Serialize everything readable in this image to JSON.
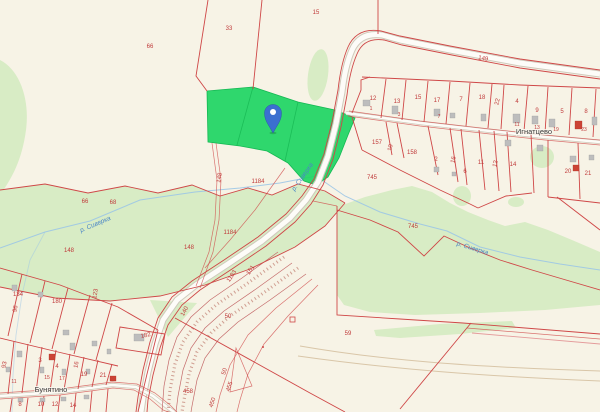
{
  "map": {
    "colors": {
      "background": "#f7f3e6",
      "vegetation": "#d8ecc5",
      "selection_green": "#1fd463",
      "boundary_red": "#cf4747",
      "road_fill": "#fdfcf8",
      "water_blue": "#9cc6e6",
      "marker_blue": "#3b6fd0",
      "parcel_number_red": "#c03b3b",
      "settlement_text": "#3b3b3b"
    },
    "marker": {
      "type": "location-pin",
      "x": 273,
      "y": 113
    },
    "settlements": [
      {
        "t": "Игнатцево",
        "x": 534,
        "y": 134
      },
      {
        "t": "Бунятино",
        "x": 51,
        "y": 392
      }
    ],
    "rivers": [
      {
        "t": "р. Сиверка",
        "x": 96,
        "y": 226,
        "r": -23
      },
      {
        "t": "р. Сиверка",
        "x": 304,
        "y": 178,
        "r": -55
      },
      {
        "t": "р. Сиверка",
        "x": 472,
        "y": 250,
        "r": 17
      }
    ],
    "parcel_labels": [
      {
        "t": "66",
        "x": 150,
        "y": 48
      },
      {
        "t": "33",
        "x": 229,
        "y": 30
      },
      {
        "t": "15",
        "x": 316,
        "y": 14
      },
      {
        "t": "149",
        "x": 483,
        "y": 60,
        "r": 9
      },
      {
        "t": "12",
        "x": 373,
        "y": 100
      },
      {
        "t": "13",
        "x": 397,
        "y": 103
      },
      {
        "t": "15",
        "x": 418,
        "y": 99
      },
      {
        "t": "17",
        "x": 437,
        "y": 102
      },
      {
        "t": "7",
        "x": 461,
        "y": 101
      },
      {
        "t": "18",
        "x": 482,
        "y": 99
      },
      {
        "t": "22",
        "x": 499,
        "y": 102,
        "r": -78
      },
      {
        "t": "4",
        "x": 517,
        "y": 103
      },
      {
        "t": "9",
        "x": 537,
        "y": 112
      },
      {
        "t": "5",
        "x": 562,
        "y": 113
      },
      {
        "t": "8",
        "x": 586,
        "y": 113
      },
      {
        "t": "1",
        "x": 371,
        "y": 110,
        "s": 5
      },
      {
        "t": "3",
        "x": 399,
        "y": 116,
        "s": 5
      },
      {
        "t": "7",
        "x": 439,
        "y": 118,
        "s": 5
      },
      {
        "t": "11",
        "x": 517,
        "y": 126,
        "s": 5
      },
      {
        "t": "13",
        "x": 537,
        "y": 129,
        "s": 5
      },
      {
        "t": "19",
        "x": 556,
        "y": 131,
        "s": 5
      },
      {
        "t": "23",
        "x": 584,
        "y": 131,
        "s": 5
      },
      {
        "t": "157",
        "x": 377,
        "y": 144
      },
      {
        "t": "10",
        "x": 392,
        "y": 148,
        "r": -78
      },
      {
        "t": "158",
        "x": 412,
        "y": 154
      },
      {
        "t": "2",
        "x": 436,
        "y": 161
      },
      {
        "t": "16",
        "x": 455,
        "y": 160,
        "r": -78
      },
      {
        "t": "6",
        "x": 465,
        "y": 173
      },
      {
        "t": "11",
        "x": 481,
        "y": 164
      },
      {
        "t": "12",
        "x": 497,
        "y": 164,
        "r": -78
      },
      {
        "t": "14",
        "x": 513,
        "y": 166
      },
      {
        "t": "20",
        "x": 568,
        "y": 173
      },
      {
        "t": "21",
        "x": 588,
        "y": 175
      },
      {
        "t": "745",
        "x": 372,
        "y": 179
      },
      {
        "t": "745",
        "x": 413,
        "y": 228
      },
      {
        "t": "148",
        "x": 221,
        "y": 178,
        "r": -80
      },
      {
        "t": "148",
        "x": 69,
        "y": 252
      },
      {
        "t": "148",
        "x": 189,
        "y": 249
      },
      {
        "t": "1184",
        "x": 258,
        "y": 183
      },
      {
        "t": "1184",
        "x": 230,
        "y": 234
      },
      {
        "t": "66",
        "x": 85,
        "y": 203
      },
      {
        "t": "68",
        "x": 113,
        "y": 204
      },
      {
        "t": "134",
        "x": 18,
        "y": 296
      },
      {
        "t": "96",
        "x": 17,
        "y": 309,
        "r": -80
      },
      {
        "t": "180",
        "x": 57,
        "y": 303
      },
      {
        "t": "123",
        "x": 97,
        "y": 294,
        "r": -80
      },
      {
        "t": "93",
        "x": 6,
        "y": 365,
        "r": -80
      },
      {
        "t": "3",
        "x": 40,
        "y": 362
      },
      {
        "t": "4",
        "x": 57,
        "y": 368
      },
      {
        "t": "16",
        "x": 78,
        "y": 365,
        "r": -80
      },
      {
        "t": "19",
        "x": 84,
        "y": 376
      },
      {
        "t": "21",
        "x": 103,
        "y": 377
      },
      {
        "t": "11",
        "x": 14,
        "y": 383,
        "s": 5
      },
      {
        "t": "15",
        "x": 47,
        "y": 379,
        "s": 5
      },
      {
        "t": "17",
        "x": 62,
        "y": 380,
        "s": 5
      },
      {
        "t": "182",
        "x": 146,
        "y": 337,
        "r": -12
      },
      {
        "t": "8",
        "x": 20,
        "y": 406
      },
      {
        "t": "10",
        "x": 41,
        "y": 406
      },
      {
        "t": "12",
        "x": 55,
        "y": 406
      },
      {
        "t": "14",
        "x": 73,
        "y": 407
      },
      {
        "t": "140",
        "x": 186,
        "y": 312,
        "r": -62
      },
      {
        "t": "1183",
        "x": 233,
        "y": 277,
        "r": -56
      },
      {
        "t": "151",
        "x": 252,
        "y": 271,
        "r": -56
      },
      {
        "t": "50",
        "x": 228,
        "y": 318
      },
      {
        "t": "50",
        "x": 226,
        "y": 372,
        "r": -72
      },
      {
        "t": "458",
        "x": 188,
        "y": 393
      },
      {
        "t": "455",
        "x": 231,
        "y": 387,
        "r": -72
      },
      {
        "t": "450",
        "x": 214,
        "y": 403,
        "r": -72
      },
      {
        "t": "59",
        "x": 348,
        "y": 335
      }
    ]
  }
}
